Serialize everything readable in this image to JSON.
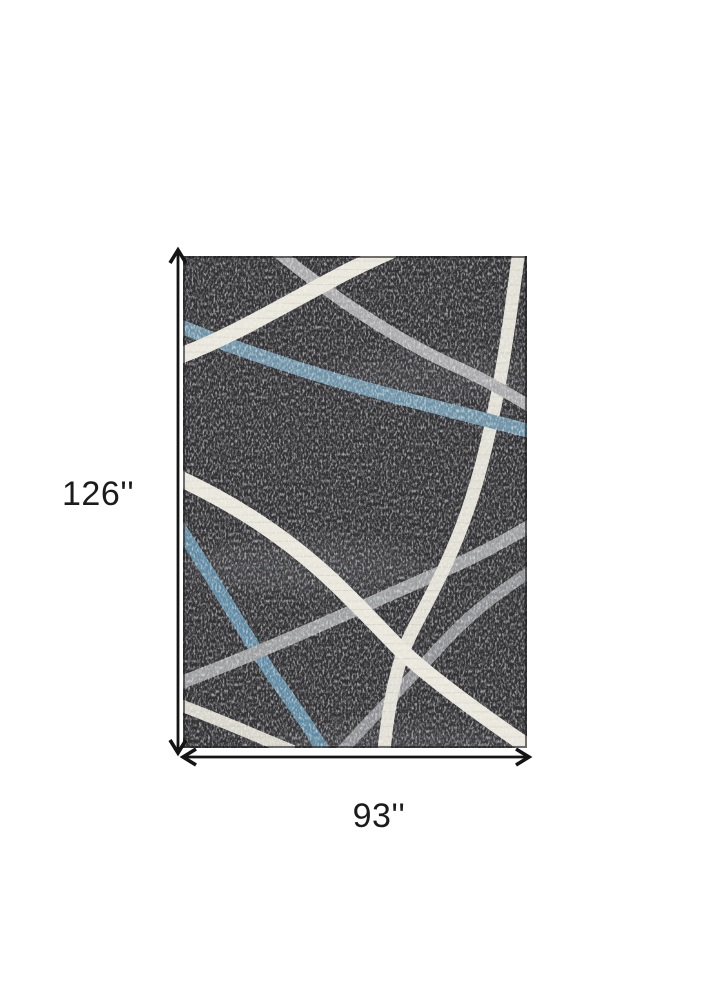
{
  "page": {
    "background": "#ffffff"
  },
  "diagram": {
    "height_label": "126''",
    "width_label": "93''",
    "arrow_color": "#141414",
    "label_color": "#1b1b1b"
  },
  "rug": {
    "base_color": "#313134",
    "edge_color": "#1d1d20",
    "colors": {
      "cream": "#e9e6da",
      "cream_soft": "#e2dfd4",
      "cream_dull": "#d8d5ca",
      "gray": "#a9a9ab",
      "gray_mid": "#9d9ea0",
      "gray_dim": "#8f9093",
      "blue": "#6e93a7",
      "blue_deep": "#5f8aa2"
    }
  }
}
